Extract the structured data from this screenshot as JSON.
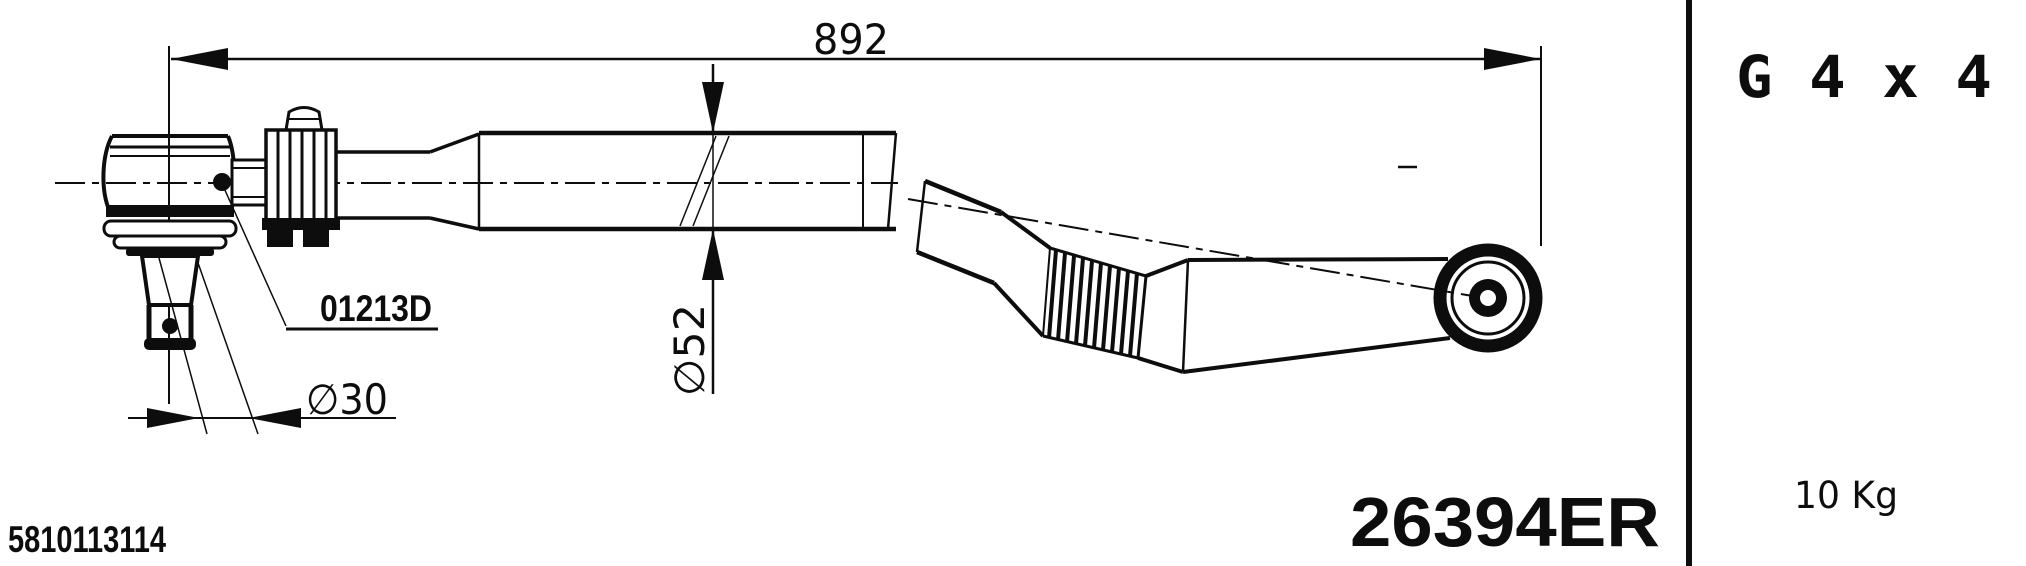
{
  "colors": {
    "ink": "#0d0d0d",
    "paper": "#ffffff"
  },
  "drawing": {
    "dimensions": {
      "overall_length": "892",
      "rod_diameter": "∅52",
      "stud_diameter": "∅30"
    },
    "labels": {
      "ball_joint_ref": "01213D",
      "drawing_number": "5810113114",
      "part_number": "26394ER"
    }
  },
  "side_panel": {
    "thread_spec": "G 4 x 4",
    "weight": "10 Kg"
  }
}
